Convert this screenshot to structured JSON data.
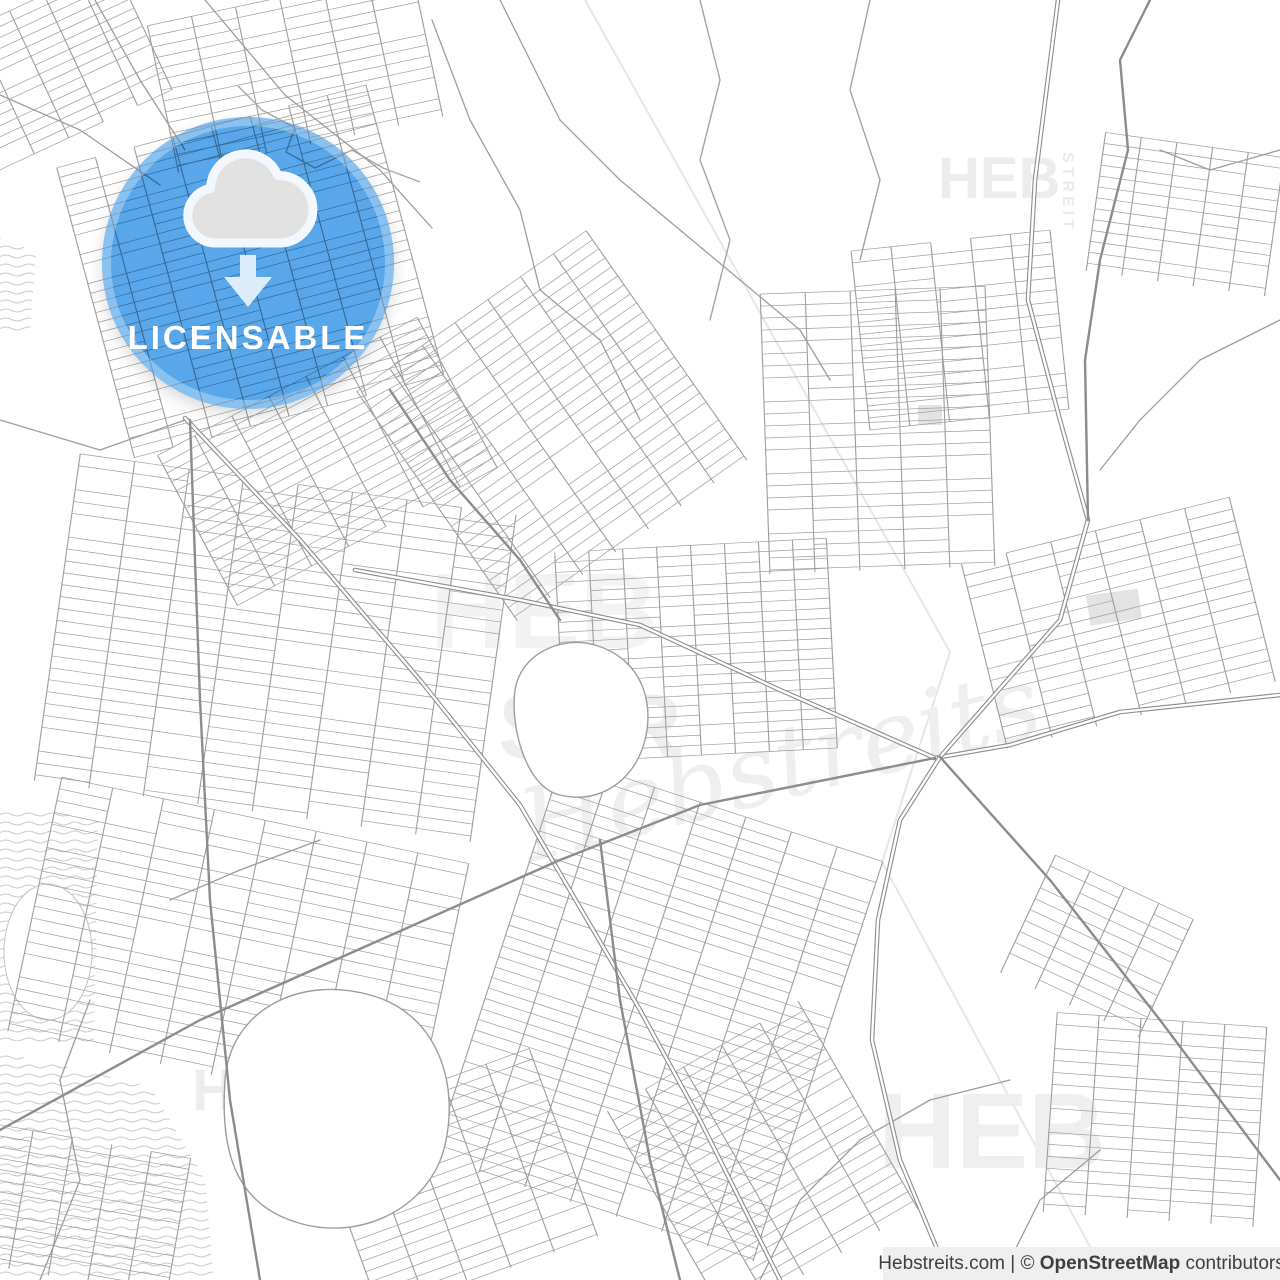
{
  "meta": {
    "width": 1280,
    "height": 1280
  },
  "badge": {
    "label": "LICENSABLE",
    "label_color": "#ffffff",
    "circle_color": "#57a7ea",
    "ring_color": "rgba(255,255,255,0.30)",
    "cloud_fill": "#e2e2e2",
    "cloud_stroke": "#f2f8fd",
    "arrow_color": "#ddecf9",
    "icon": "cloud-download-icon"
  },
  "attribution": {
    "prefix": "Hebstreits.com | © ",
    "strong": "OpenStreetMap",
    "suffix": " contributors",
    "bg": "#efefef",
    "color": "#3d4043"
  },
  "watermark": {
    "items": [
      {
        "text": "HEB",
        "x": 938,
        "y": 198,
        "size": 58,
        "weight": "bold",
        "color": "#ededed"
      },
      {
        "text": "STREIT",
        "x": 1063,
        "y": 152,
        "size": 16,
        "weight": "bold",
        "color": "#ebebeb",
        "rotate": 90,
        "spacing": 4
      },
      {
        "text": "HEB",
        "x": 192,
        "y": 1110,
        "size": 58,
        "weight": "bold",
        "color": "#ededed"
      },
      {
        "text": "STREIT",
        "x": 322,
        "y": 1062,
        "size": 16,
        "weight": "bold",
        "color": "#ebebeb",
        "rotate": 90,
        "spacing": 4
      },
      {
        "text": "HEB",
        "x": 878,
        "y": 1168,
        "size": 108,
        "weight": "bold",
        "color": "#efefef"
      },
      {
        "text": "HEB",
        "x": 430,
        "y": 648,
        "size": 108,
        "weight": "bold",
        "color": "#f3f3f3"
      },
      {
        "text": "STR",
        "x": 498,
        "y": 758,
        "size": 92,
        "weight": "bold",
        "color": "#eeeeee"
      },
      {
        "text": "Hebstreits",
        "x": 530,
        "y": 862,
        "size": 100,
        "weight": "normal",
        "italic": true,
        "serif": true,
        "rotate": -14,
        "color": "#efefef"
      }
    ]
  },
  "map": {
    "street_color": "#9d9d9d",
    "major_color": "#8c8c8c",
    "faint_color": "#e7e7e7",
    "river_color": "#a8a8a8",
    "wave_color": "#cbcbcb",
    "area_fill_color": "#e3e3e3",
    "faint_lines": [
      [
        [
          585,
          0
        ],
        [
          950,
          652
        ]
      ],
      [
        [
          950,
          652
        ],
        [
          882,
          862
        ]
      ],
      [
        [
          882,
          862
        ],
        [
          1108,
          1280
        ]
      ]
    ],
    "wetlands": [
      "M0,806 L98,818 L94,1046 L0,1040 Z",
      "M0,1052 L150,1086 L205,1180 L214,1280 L0,1280 Z",
      "M0,238 L36,252 L30,334 L0,330 Z"
    ],
    "wetland_blob": [
      48,
      952,
      44,
      68
    ],
    "area_fills": [
      {
        "x": 1088,
        "y": 592,
        "w": 52,
        "h": 30,
        "rot": -8
      },
      {
        "x": 918,
        "y": 405,
        "w": 24,
        "h": 20,
        "rot": 0
      }
    ],
    "districts": [
      {
        "cx": 70,
        "cy": 60,
        "w": 220,
        "h": 140,
        "a": -25,
        "maj": 38,
        "min": 10
      },
      {
        "cx": 300,
        "cy": 70,
        "w": 280,
        "h": 150,
        "a": -12,
        "maj": 45,
        "min": 11
      },
      {
        "cx": 255,
        "cy": 270,
        "w": 330,
        "h": 300,
        "a": -15,
        "maj": 40,
        "min": 10
      },
      {
        "cx": 330,
        "cy": 460,
        "w": 300,
        "h": 170,
        "a": -28,
        "maj": 42,
        "min": 10
      },
      {
        "cx": 290,
        "cy": 650,
        "w": 470,
        "h": 330,
        "a": 8,
        "maj": 55,
        "min": 12
      },
      {
        "cx": 250,
        "cy": 950,
        "w": 440,
        "h": 260,
        "a": 12,
        "maj": 52,
        "min": 12
      },
      {
        "cx": 560,
        "cy": 420,
        "w": 300,
        "h": 280,
        "a": -35,
        "maj": 40,
        "min": 11
      },
      {
        "cx": 700,
        "cy": 650,
        "w": 280,
        "h": 210,
        "a": -3,
        "maj": 34,
        "min": 10
      },
      {
        "cx": 880,
        "cy": 430,
        "w": 230,
        "h": 280,
        "a": -2,
        "maj": 45,
        "min": 12
      },
      {
        "cx": 660,
        "cy": 1010,
        "w": 340,
        "h": 420,
        "a": 18,
        "maj": 48,
        "min": 11
      },
      {
        "cx": 780,
        "cy": 1150,
        "w": 260,
        "h": 240,
        "a": -30,
        "maj": 44,
        "min": 11
      },
      {
        "cx": 1130,
        "cy": 620,
        "w": 300,
        "h": 190,
        "a": -14,
        "maj": 46,
        "min": 12
      },
      {
        "cx": 1190,
        "cy": 215,
        "w": 190,
        "h": 140,
        "a": 8,
        "maj": 36,
        "min": 11
      },
      {
        "cx": 1160,
        "cy": 1120,
        "w": 220,
        "h": 200,
        "a": 4,
        "maj": 42,
        "min": 12
      },
      {
        "cx": 460,
        "cy": 1180,
        "w": 240,
        "h": 200,
        "a": -20,
        "maj": 46,
        "min": 11
      },
      {
        "cx": 80,
        "cy": 1210,
        "w": 200,
        "h": 140,
        "a": 10,
        "maj": 40,
        "min": 11
      },
      {
        "cx": 960,
        "cy": 330,
        "w": 200,
        "h": 180,
        "a": -6,
        "maj": 40,
        "min": 12
      },
      {
        "cx": 1105,
        "cy": 950,
        "w": 170,
        "h": 130,
        "a": 25,
        "maj": 38,
        "min": 12
      }
    ],
    "blobs": [
      "M515,690 C520,655 560,635 595,645 C640,658 655,700 645,740 C635,780 600,805 560,795 C525,787 510,725 515,690 Z",
      "M225,1080 C230,1010 300,975 370,995 C435,1012 460,1080 445,1145 C430,1210 355,1245 290,1220 C235,1200 220,1150 225,1080 Z"
    ],
    "rivers": [
      [
        [
          238,
          86
        ],
        [
          262,
          110
        ],
        [
          295,
          128
        ],
        [
          286,
          152
        ],
        [
          315,
          168
        ],
        [
          352,
          150
        ],
        [
          383,
          168
        ],
        [
          420,
          182
        ]
      ]
    ],
    "minor_roads": [
      [
        [
          205,
          0
        ],
        [
          285,
          95
        ],
        [
          380,
          170
        ],
        [
          432,
          228
        ]
      ],
      [
        [
          95,
          0
        ],
        [
          140,
          80
        ],
        [
          185,
          150
        ]
      ],
      [
        [
          0,
          95
        ],
        [
          80,
          130
        ],
        [
          160,
          185
        ]
      ],
      [
        [
          432,
          20
        ],
        [
          470,
          120
        ],
        [
          520,
          210
        ],
        [
          540,
          290
        ]
      ],
      [
        [
          540,
          290
        ],
        [
          600,
          340
        ],
        [
          640,
          420
        ]
      ],
      [
        [
          0,
          420
        ],
        [
          100,
          450
        ],
        [
          185,
          420
        ]
      ],
      [
        [
          40,
          1280
        ],
        [
          80,
          1180
        ],
        [
          60,
          1080
        ],
        [
          90,
          1000
        ]
      ],
      [
        [
          700,
          0
        ],
        [
          720,
          80
        ],
        [
          700,
          160
        ],
        [
          730,
          240
        ],
        [
          710,
          320
        ]
      ],
      [
        [
          870,
          0
        ],
        [
          850,
          90
        ],
        [
          880,
          180
        ],
        [
          860,
          260
        ]
      ],
      [
        [
          500,
          0
        ],
        [
          530,
          60
        ],
        [
          560,
          120
        ]
      ],
      [
        [
          560,
          120
        ],
        [
          620,
          180
        ],
        [
          680,
          230
        ],
        [
          740,
          280
        ]
      ],
      [
        [
          740,
          280
        ],
        [
          800,
          330
        ],
        [
          830,
          380
        ]
      ],
      [
        [
          1280,
          320
        ],
        [
          1200,
          360
        ],
        [
          1140,
          420
        ],
        [
          1100,
          470
        ]
      ],
      [
        [
          1280,
          150
        ],
        [
          1210,
          170
        ],
        [
          1160,
          150
        ]
      ],
      [
        [
          1000,
          1280
        ],
        [
          1040,
          1200
        ],
        [
          1100,
          1150
        ]
      ],
      [
        [
          760,
          1280
        ],
        [
          800,
          1200
        ],
        [
          860,
          1140
        ],
        [
          930,
          1100
        ],
        [
          1010,
          1080
        ]
      ],
      [
        [
          170,
          900
        ],
        [
          240,
          870
        ],
        [
          320,
          840
        ]
      ]
    ],
    "major_roads": [
      {
        "pts": [
          [
            185,
            418
          ],
          [
            300,
            540
          ],
          [
            420,
            680
          ],
          [
            520,
            805
          ],
          [
            640,
            1010
          ],
          [
            700,
            1120
          ],
          [
            780,
            1280
          ]
        ],
        "double": true
      },
      {
        "pts": [
          [
            355,
            570
          ],
          [
            520,
            600
          ],
          [
            640,
            625
          ],
          [
            780,
            690
          ],
          [
            860,
            725
          ],
          [
            935,
            758
          ],
          [
            1010,
            745
          ],
          [
            1120,
            712
          ],
          [
            1280,
            695
          ]
        ],
        "double": true
      },
      {
        "pts": [
          [
            0,
            1130
          ],
          [
            200,
            1020
          ],
          [
            380,
            940
          ],
          [
            560,
            860
          ],
          [
            700,
            805
          ],
          [
            935,
            758
          ]
        ],
        "double": false
      },
      {
        "pts": [
          [
            1058,
            0
          ],
          [
            1035,
            180
          ],
          [
            1028,
            300
          ],
          [
            1060,
            420
          ],
          [
            1088,
            520
          ],
          [
            1060,
            620
          ],
          [
            990,
            700
          ],
          [
            940,
            757
          ],
          [
            900,
            820
          ],
          [
            878,
            920
          ],
          [
            872,
            1040
          ],
          [
            900,
            1160
          ],
          [
            950,
            1280
          ]
        ],
        "double": true
      },
      {
        "pts": [
          [
            940,
            757
          ],
          [
            1050,
            880
          ],
          [
            1160,
            1020
          ],
          [
            1280,
            1180
          ]
        ],
        "double": false
      },
      {
        "pts": [
          [
            1150,
            0
          ],
          [
            1120,
            60
          ],
          [
            1128,
            150
          ],
          [
            1100,
            260
          ],
          [
            1085,
            360
          ],
          [
            1088,
            520
          ]
        ],
        "double": false
      },
      {
        "pts": [
          [
            390,
            390
          ],
          [
            450,
            480
          ],
          [
            520,
            560
          ],
          [
            560,
            620
          ]
        ],
        "double": false
      },
      {
        "pts": [
          [
            190,
            420
          ],
          [
            200,
            700
          ],
          [
            210,
            900
          ],
          [
            230,
            1100
          ],
          [
            260,
            1280
          ]
        ],
        "double": false
      },
      {
        "pts": [
          [
            600,
            840
          ],
          [
            620,
            1000
          ],
          [
            650,
            1160
          ],
          [
            680,
            1280
          ]
        ],
        "double": false
      }
    ]
  }
}
